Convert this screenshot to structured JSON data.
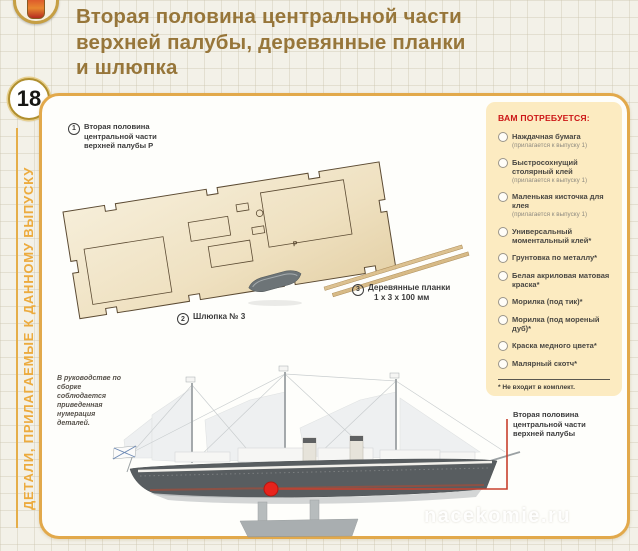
{
  "header": {
    "issue_number": "18",
    "sidebar_caption": "ДЕТАЛИ, ПРИЛАГАЕМЫЕ К ДАННОМУ ВЫПУСКУ",
    "title_lines": [
      "Вторая половина центральной части",
      "верхней палубы, деревянные планки",
      "и шлюпка"
    ]
  },
  "parts": [
    {
      "number": "1",
      "lines": [
        "Вторая половина",
        "центральной части",
        "верхней палубы Р"
      ],
      "mark": "Р"
    },
    {
      "number": "2",
      "label": "Шлюпка № 3"
    },
    {
      "number": "3",
      "label": "Деревянные планки",
      "size": "1 х 3 х 100 мм"
    }
  ],
  "required": {
    "title": "ВАМ ПОТРЕБУЕТСЯ:",
    "items": [
      {
        "label": "Наждачная бумага",
        "note": "(прилагается к выпуску 1)"
      },
      {
        "label": "Быстросохнущий столярный клей",
        "note": "(прилагается к выпуску 1)"
      },
      {
        "label": "Маленькая кисточка для клея",
        "note": "(прилагается к выпуску 1)"
      },
      {
        "label": "Универсальный моментальный клей*"
      },
      {
        "label": "Грунтовка по металлу*"
      },
      {
        "label": "Белая акриловая матовая краска*"
      },
      {
        "label": "Морилка (под тик)*"
      },
      {
        "label": "Морилка (под мореный дуб)*"
      },
      {
        "label": "Краска медного цвета*"
      },
      {
        "label": "Малярный скотч*"
      }
    ],
    "footnote": "* Не входит в комплект."
  },
  "note_text": "В руководстве по сборке соблюдается приведенная нумерация деталей.",
  "ship_callout": {
    "lines": [
      "Вторая половина",
      "центральной части",
      "верхней палубы"
    ]
  },
  "watermark": "nacekomie.ru",
  "colors": {
    "panel_border_gold": "#e2a94b",
    "title_brown": "#97763a",
    "sidebar_gold": "#ecab3e",
    "heading_red": "#cc1616",
    "callout_red": "#c8402e",
    "marker_red": "#e8231c",
    "wood_light": "#f4ead3"
  }
}
